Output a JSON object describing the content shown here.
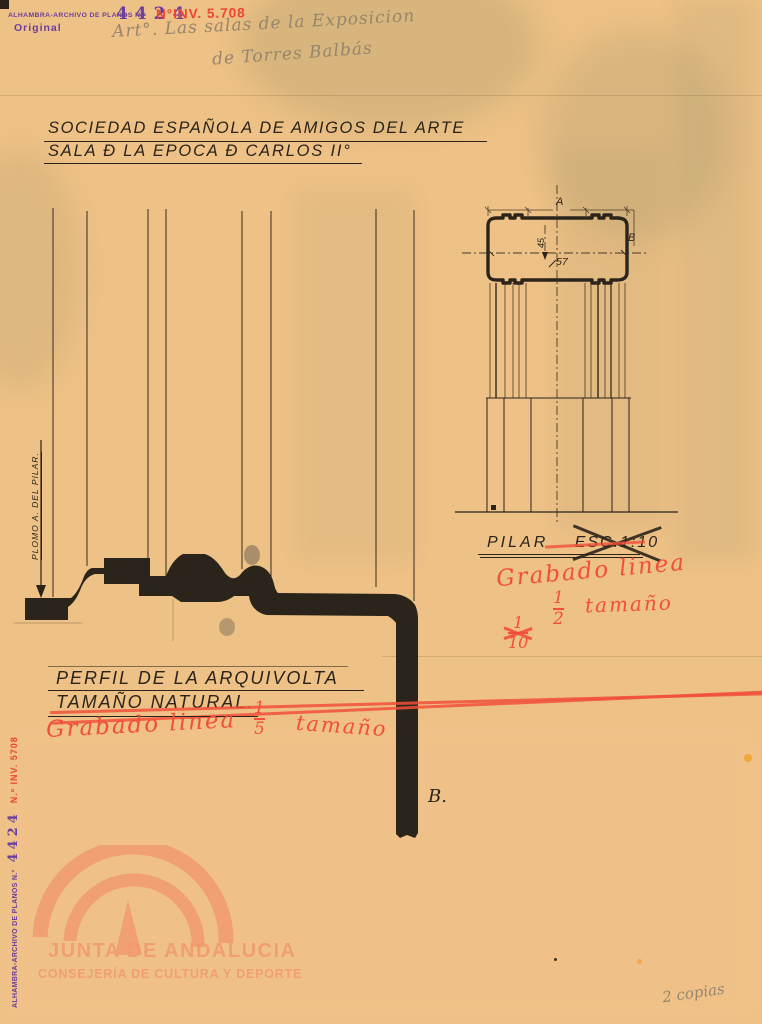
{
  "colors": {
    "paper": "#eec186",
    "ink": "#2b241a",
    "stamp_purple": "#6b3f9e",
    "stamp_red": "#ee4430",
    "red_note": "#f0503a",
    "pencil": "#95866c",
    "watermark": "#f2996e"
  },
  "header": {
    "archive_stamp": "ALHAMBRA-ARCHIVO DE PLANOS N.°",
    "archive_number": "4424",
    "original_stamp": "Original",
    "inventory_note": "N°INV. 5.708",
    "pencil_note_line1": "Art°. Las salas de la Exposicion",
    "pencil_note_line2": "de Torres Balbás"
  },
  "title": {
    "line1": "SOCIEDAD ESPAÑOLA DE AMIGOS DEL ARTE",
    "line2": "SALA Đ LA EPOCA Đ CARLOS II°"
  },
  "profile_drawing": {
    "plumb_label": "PLOMO A. DEL PILAR.",
    "point_label": "B.",
    "caption_line1": "PERFIL DE LA ARQUIVOLTA",
    "caption_line2": "TAMAÑO NATURAL.",
    "red_note": "Grabado linea",
    "fraction_numerator": "1",
    "fraction_denominator": "5",
    "red_note_tail": "tamaño"
  },
  "pilar_drawing": {
    "dim_a": "A",
    "dim_b": "B",
    "dim_vertical": "45",
    "dim_horizontal": "57",
    "caption": "PILAR",
    "scale_label": "ESC.1:10",
    "red_note": "Grabado linea",
    "struck_fraction_numerator": "1",
    "struck_fraction_denominator": "10",
    "fraction_numerator": "1",
    "fraction_denominator": "2",
    "red_note_tail": "tamaño"
  },
  "watermark": {
    "line1": "JUNTA DE ANDALUCIA",
    "line2": "CONSEJERÍA DE CULTURA Y DEPORTE"
  },
  "side_stamp": {
    "label": "ALHAMBRA-ARCHIVO DE PLANOS N.°",
    "number": "4424",
    "inventory": "N.º INV. 5708"
  },
  "footer": {
    "copies_note": "2 copias"
  }
}
